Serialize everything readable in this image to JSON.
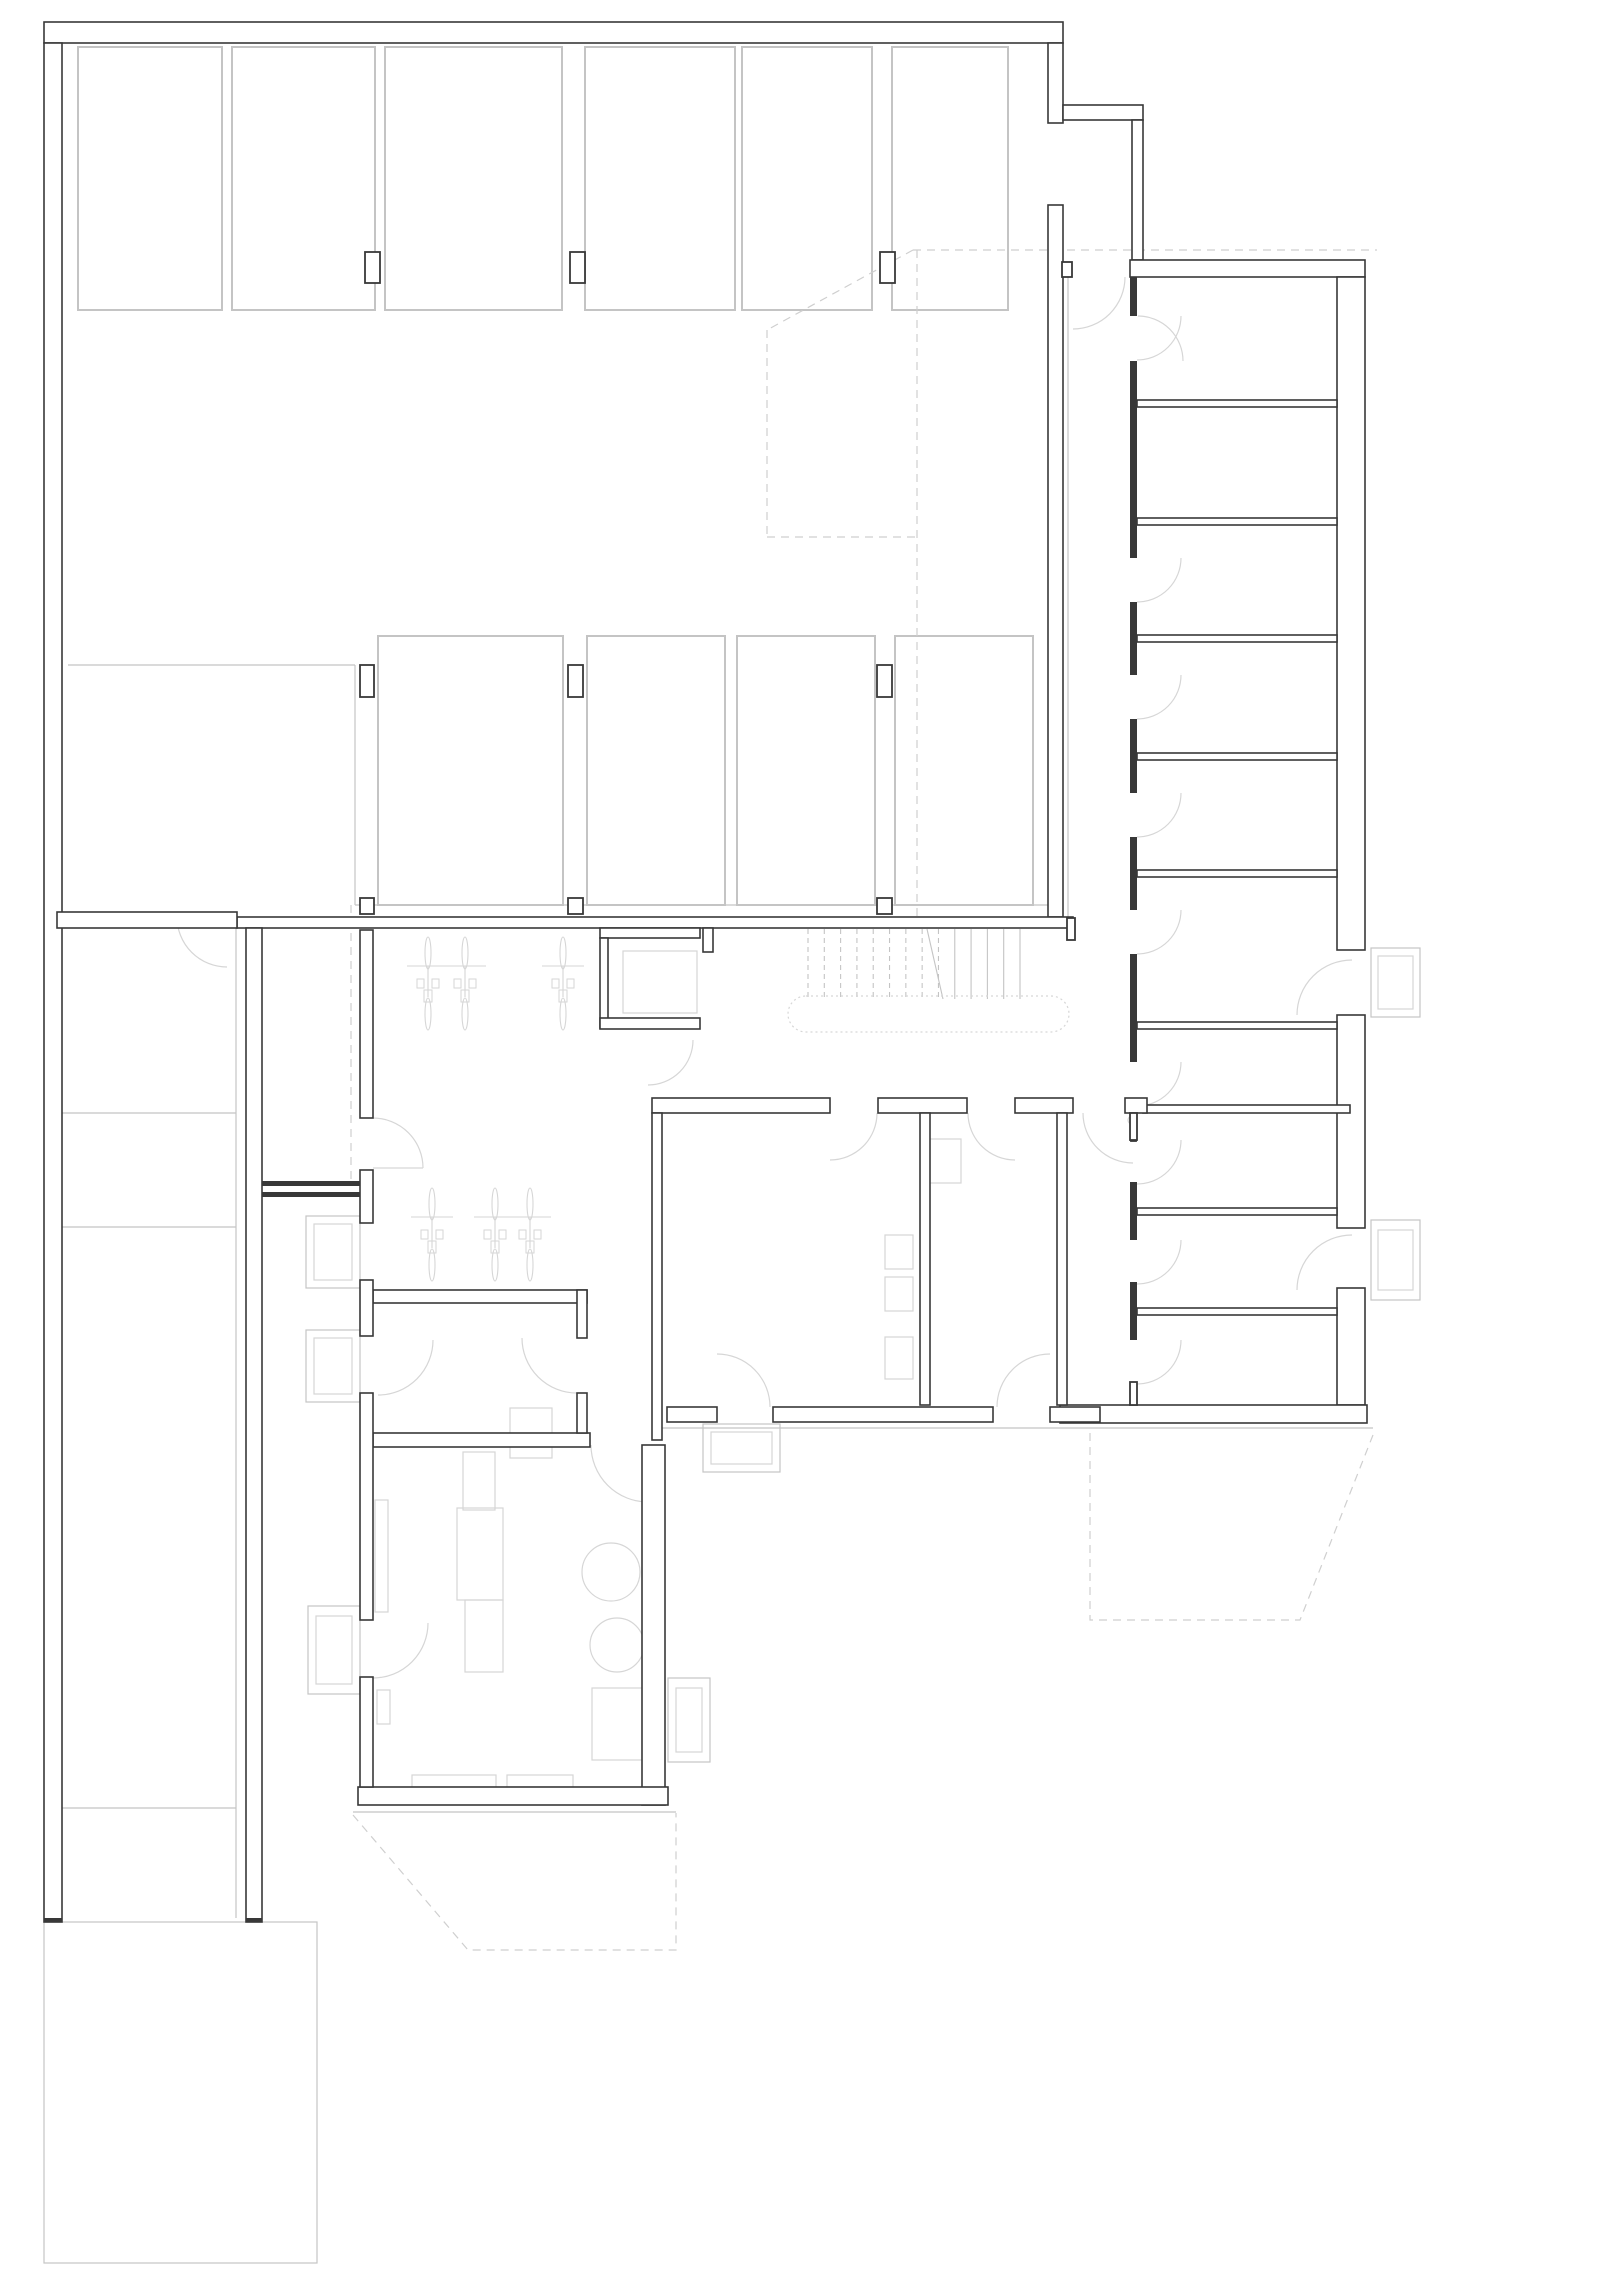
{
  "drawing_title": "basement-floor-plan",
  "colors": {
    "background": "#ffffff",
    "wall_dark": "#383838",
    "line_light": "#c4c4c4",
    "line_xlight": "#d6d6d6",
    "dash": "#cfcfcf"
  },
  "canvas": {
    "width": 1600,
    "height": 2285
  },
  "plan": {
    "dwalls": [
      {
        "x": 44,
        "y": 22,
        "w": 1019,
        "h": 21
      },
      {
        "x": 44,
        "y": 43,
        "w": 18,
        "h": 1879
      },
      {
        "x": 1048,
        "y": 43,
        "w": 15,
        "h": 80
      },
      {
        "x": 1048,
        "y": 205,
        "w": 15,
        "h": 712
      },
      {
        "x": 1063,
        "y": 105,
        "w": 80,
        "h": 15
      },
      {
        "x": 1132,
        "y": 120,
        "w": 11,
        "h": 140
      },
      {
        "x": 237,
        "y": 917,
        "w": 836,
        "h": 11
      },
      {
        "x": 57,
        "y": 912,
        "w": 180,
        "h": 16
      },
      {
        "x": 246,
        "y": 928,
        "w": 16,
        "h": 994
      },
      {
        "x": 1130,
        "y": 260,
        "w": 235,
        "h": 17
      },
      {
        "x": 1337,
        "y": 277,
        "w": 28,
        "h": 673
      },
      {
        "x": 1337,
        "y": 1015,
        "w": 28,
        "h": 213
      },
      {
        "x": 1337,
        "y": 1288,
        "w": 28,
        "h": 117
      },
      {
        "x": 1137,
        "y": 400,
        "w": 200,
        "h": 7
      },
      {
        "x": 1137,
        "y": 518,
        "w": 200,
        "h": 7
      },
      {
        "x": 1137,
        "y": 635,
        "w": 200,
        "h": 7
      },
      {
        "x": 1137,
        "y": 753,
        "w": 200,
        "h": 7
      },
      {
        "x": 1137,
        "y": 870,
        "w": 200,
        "h": 7
      },
      {
        "x": 1137,
        "y": 1022,
        "w": 200,
        "h": 7
      },
      {
        "x": 1137,
        "y": 1208,
        "w": 200,
        "h": 7
      },
      {
        "x": 1137,
        "y": 1308,
        "w": 200,
        "h": 7
      },
      {
        "x": 1143,
        "y": 1105,
        "w": 207,
        "h": 8
      },
      {
        "x": 1060,
        "y": 1405,
        "w": 307,
        "h": 18
      },
      {
        "x": 652,
        "y": 1098,
        "w": 178,
        "h": 15
      },
      {
        "x": 878,
        "y": 1098,
        "w": 89,
        "h": 15
      },
      {
        "x": 1015,
        "y": 1098,
        "w": 58,
        "h": 15
      },
      {
        "x": 1125,
        "y": 1098,
        "w": 22,
        "h": 15
      },
      {
        "x": 600,
        "y": 928,
        "w": 100,
        "h": 10
      },
      {
        "x": 600,
        "y": 938,
        "w": 8,
        "h": 90
      },
      {
        "x": 600,
        "y": 1018,
        "w": 100,
        "h": 11
      },
      {
        "x": 703,
        "y": 928,
        "w": 10,
        "h": 24
      },
      {
        "x": 652,
        "y": 1113,
        "w": 10,
        "h": 327
      },
      {
        "x": 920,
        "y": 1113,
        "w": 10,
        "h": 292
      },
      {
        "x": 1057,
        "y": 1113,
        "w": 10,
        "h": 292
      },
      {
        "x": 667,
        "y": 1407,
        "w": 50,
        "h": 15
      },
      {
        "x": 773,
        "y": 1407,
        "w": 220,
        "h": 15
      },
      {
        "x": 1050,
        "y": 1407,
        "w": 50,
        "h": 15
      },
      {
        "x": 373,
        "y": 1290,
        "w": 214,
        "h": 13
      },
      {
        "x": 577,
        "y": 1290,
        "w": 10,
        "h": 48
      },
      {
        "x": 373,
        "y": 1433,
        "w": 217,
        "h": 14
      },
      {
        "x": 577,
        "y": 1393,
        "w": 10,
        "h": 40
      },
      {
        "x": 642,
        "y": 1445,
        "w": 23,
        "h": 360
      },
      {
        "x": 358,
        "y": 1787,
        "w": 310,
        "h": 18
      },
      {
        "x": 360,
        "y": 1393,
        "w": 13,
        "h": 227
      },
      {
        "x": 360,
        "y": 1677,
        "w": 13,
        "h": 110
      },
      {
        "x": 360,
        "y": 930,
        "w": 13,
        "h": 188
      },
      {
        "x": 360,
        "y": 1170,
        "w": 13,
        "h": 53
      },
      {
        "x": 360,
        "y": 1280,
        "w": 13,
        "h": 56
      }
    ],
    "swalls": [
      {
        "x": 365,
        "y": 252,
        "w": 15,
        "h": 31
      },
      {
        "x": 570,
        "y": 252,
        "w": 15,
        "h": 31
      },
      {
        "x": 880,
        "y": 252,
        "w": 15,
        "h": 31
      },
      {
        "x": 360,
        "y": 665,
        "w": 14,
        "h": 32
      },
      {
        "x": 568,
        "y": 665,
        "w": 15,
        "h": 32
      },
      {
        "x": 877,
        "y": 665,
        "w": 15,
        "h": 32
      },
      {
        "x": 360,
        "y": 898,
        "w": 14,
        "h": 16
      },
      {
        "x": 568,
        "y": 898,
        "w": 15,
        "h": 16
      },
      {
        "x": 877,
        "y": 898,
        "w": 15,
        "h": 16
      },
      {
        "x": 1062,
        "y": 262,
        "w": 10,
        "h": 15
      },
      {
        "x": 1067,
        "y": 918,
        "w": 8,
        "h": 22
      },
      {
        "x": 262,
        "y": 1181,
        "w": 98,
        "h": 5
      },
      {
        "x": 262,
        "y": 1192,
        "w": 98,
        "h": 5
      },
      {
        "x": 44,
        "y": 1918,
        "w": 18,
        "h": 4
      },
      {
        "x": 246,
        "y": 1918,
        "w": 16,
        "h": 4
      },
      {
        "x": 1131,
        "y": 1125,
        "w": 5,
        "h": 16
      },
      {
        "x": 1130,
        "y": 277,
        "w": 7,
        "h": 39
      },
      {
        "x": 1130,
        "y": 361,
        "w": 7,
        "h": 197
      },
      {
        "x": 1130,
        "y": 602,
        "w": 7,
        "h": 73
      },
      {
        "x": 1130,
        "y": 719,
        "w": 7,
        "h": 74
      },
      {
        "x": 1130,
        "y": 837,
        "w": 7,
        "h": 73
      },
      {
        "x": 1130,
        "y": 954,
        "w": 7,
        "h": 108
      },
      {
        "x": 1130,
        "y": 1113,
        "w": 7,
        "h": 27
      },
      {
        "x": 1130,
        "y": 1182,
        "w": 7,
        "h": 58
      },
      {
        "x": 1130,
        "y": 1282,
        "w": 7,
        "h": 58
      },
      {
        "x": 1130,
        "y": 1382,
        "w": 7,
        "h": 23
      }
    ],
    "stalls": [
      {
        "x": 78,
        "y": 47,
        "w": 144,
        "h": 263
      },
      {
        "x": 232,
        "y": 47,
        "w": 143,
        "h": 263
      },
      {
        "x": 385,
        "y": 47,
        "w": 177,
        "h": 263
      },
      {
        "x": 585,
        "y": 47,
        "w": 150,
        "h": 263
      },
      {
        "x": 742,
        "y": 47,
        "w": 130,
        "h": 263
      },
      {
        "x": 892,
        "y": 47,
        "w": 116,
        "h": 263
      },
      {
        "x": 378,
        "y": 636,
        "w": 185,
        "h": 269
      },
      {
        "x": 587,
        "y": 636,
        "w": 138,
        "h": 269
      },
      {
        "x": 737,
        "y": 636,
        "w": 138,
        "h": 269
      },
      {
        "x": 895,
        "y": 636,
        "w": 138,
        "h": 269
      }
    ],
    "lrects": [
      {
        "x": 44,
        "y": 1922,
        "w": 273,
        "h": 341,
        "cls": "light"
      },
      {
        "x": 306,
        "y": 1216,
        "w": 54,
        "h": 72,
        "cls": "light"
      },
      {
        "x": 314,
        "y": 1224,
        "w": 38,
        "h": 56,
        "cls": "xlight"
      },
      {
        "x": 306,
        "y": 1330,
        "w": 54,
        "h": 72,
        "cls": "light"
      },
      {
        "x": 314,
        "y": 1338,
        "w": 38,
        "h": 56,
        "cls": "xlight"
      },
      {
        "x": 308,
        "y": 1606,
        "w": 52,
        "h": 88,
        "cls": "light"
      },
      {
        "x": 316,
        "y": 1616,
        "w": 36,
        "h": 68,
        "cls": "xlight"
      },
      {
        "x": 703,
        "y": 1424,
        "w": 77,
        "h": 48,
        "cls": "light"
      },
      {
        "x": 711,
        "y": 1432,
        "w": 61,
        "h": 32,
        "cls": "xlight"
      },
      {
        "x": 668,
        "y": 1678,
        "w": 42,
        "h": 84,
        "cls": "light"
      },
      {
        "x": 676,
        "y": 1688,
        "w": 26,
        "h": 64,
        "cls": "xlight"
      },
      {
        "x": 1371,
        "y": 948,
        "w": 49,
        "h": 69,
        "cls": "light"
      },
      {
        "x": 1378,
        "y": 956,
        "w": 35,
        "h": 53,
        "cls": "xlight"
      },
      {
        "x": 1371,
        "y": 1220,
        "w": 49,
        "h": 80,
        "cls": "light"
      },
      {
        "x": 1378,
        "y": 1230,
        "w": 35,
        "h": 60,
        "cls": "xlight"
      },
      {
        "x": 623,
        "y": 951,
        "w": 74,
        "h": 62,
        "cls": "xlight"
      },
      {
        "x": 457,
        "y": 1508,
        "w": 46,
        "h": 92,
        "cls": "xlight"
      },
      {
        "x": 465,
        "y": 1600,
        "w": 38,
        "h": 72,
        "cls": "xlight"
      },
      {
        "x": 463,
        "y": 1452,
        "w": 32,
        "h": 58,
        "cls": "xlight"
      },
      {
        "x": 510,
        "y": 1408,
        "w": 42,
        "h": 50,
        "cls": "xlight"
      },
      {
        "x": 412,
        "y": 1775,
        "w": 84,
        "h": 12,
        "cls": "xlight"
      },
      {
        "x": 507,
        "y": 1775,
        "w": 66,
        "h": 12,
        "cls": "xlight"
      },
      {
        "x": 375,
        "y": 1500,
        "w": 13,
        "h": 112,
        "cls": "xlight"
      },
      {
        "x": 377,
        "y": 1690,
        "w": 13,
        "h": 34,
        "cls": "xlight"
      },
      {
        "x": 592,
        "y": 1688,
        "w": 50,
        "h": 72,
        "cls": "xlight"
      },
      {
        "x": 885,
        "y": 1235,
        "w": 28,
        "h": 34,
        "cls": "xlight"
      },
      {
        "x": 885,
        "y": 1277,
        "w": 28,
        "h": 34,
        "cls": "xlight"
      },
      {
        "x": 885,
        "y": 1337,
        "w": 28,
        "h": 42,
        "cls": "xlight"
      },
      {
        "x": 929,
        "y": 1139,
        "w": 32,
        "h": 44,
        "cls": "xlight"
      }
    ],
    "llines": [
      {
        "x1": 59,
        "y1": 928,
        "x2": 59,
        "y2": 1918,
        "cls": "light"
      },
      {
        "x1": 236,
        "y1": 928,
        "x2": 236,
        "y2": 1918,
        "cls": "light"
      },
      {
        "x1": 59,
        "y1": 1113,
        "x2": 236,
        "y2": 1113,
        "cls": "light"
      },
      {
        "x1": 59,
        "y1": 1227,
        "x2": 236,
        "y2": 1227,
        "cls": "light"
      },
      {
        "x1": 59,
        "y1": 1808,
        "x2": 236,
        "y2": 1808,
        "cls": "light"
      },
      {
        "x1": 68,
        "y1": 665,
        "x2": 355,
        "y2": 665,
        "cls": "light"
      },
      {
        "x1": 355,
        "y1": 665,
        "x2": 355,
        "y2": 905,
        "cls": "light"
      },
      {
        "x1": 355,
        "y1": 905,
        "x2": 1048,
        "y2": 905,
        "cls": "light"
      },
      {
        "x1": 1068,
        "y1": 277,
        "x2": 1068,
        "y2": 918,
        "cls": "light"
      },
      {
        "x1": 660,
        "y1": 1428,
        "x2": 1373,
        "y2": 1428,
        "cls": "light"
      },
      {
        "x1": 353,
        "y1": 1812,
        "x2": 676,
        "y2": 1812,
        "cls": "light"
      },
      {
        "x1": 373,
        "y1": 1168,
        "x2": 423,
        "y2": 1168,
        "cls": "xlight"
      }
    ],
    "dashes": [
      {
        "pts": [
          [
            913,
            250
          ],
          [
            1377,
            250
          ]
        ]
      },
      {
        "pts": [
          [
            913,
            250
          ],
          [
            767,
            330
          ]
        ]
      },
      {
        "pts": [
          [
            767,
            330
          ],
          [
            767,
            537
          ]
        ]
      },
      {
        "pts": [
          [
            767,
            537
          ],
          [
            917,
            537
          ]
        ]
      },
      {
        "pts": [
          [
            917,
            250
          ],
          [
            917,
            918
          ]
        ]
      },
      {
        "pts": [
          [
            351,
            905
          ],
          [
            351,
            1180
          ]
        ]
      },
      {
        "pts": [
          [
            353,
            1815
          ],
          [
            468,
            1950
          ],
          [
            676,
            1950
          ],
          [
            676,
            1813
          ]
        ]
      },
      {
        "pts": [
          [
            1090,
            1433
          ],
          [
            1090,
            1620
          ],
          [
            1300,
            1620
          ],
          [
            1373,
            1435
          ]
        ]
      }
    ],
    "arcs": [
      {
        "cx": 1137,
        "cy": 316,
        "r": 44,
        "a0": 0,
        "a1": 90
      },
      {
        "cx": 1137,
        "cy": 558,
        "r": 44,
        "a0": 0,
        "a1": 90
      },
      {
        "cx": 1137,
        "cy": 675,
        "r": 44,
        "a0": 0,
        "a1": 90
      },
      {
        "cx": 1137,
        "cy": 793,
        "r": 44,
        "a0": 0,
        "a1": 90
      },
      {
        "cx": 1137,
        "cy": 910,
        "r": 44,
        "a0": 0,
        "a1": 90
      },
      {
        "cx": 1137,
        "cy": 1062,
        "r": 44,
        "a0": 0,
        "a1": 90
      },
      {
        "cx": 1137,
        "cy": 1140,
        "r": 44,
        "a0": 0,
        "a1": 90
      },
      {
        "cx": 1137,
        "cy": 1240,
        "r": 44,
        "a0": 0,
        "a1": 90
      },
      {
        "cx": 1137,
        "cy": 1340,
        "r": 44,
        "a0": 0,
        "a1": 90
      },
      {
        "cx": 227,
        "cy": 917,
        "r": 50,
        "a0": 90,
        "a1": 180
      },
      {
        "cx": 1073,
        "cy": 277,
        "r": 52,
        "a0": 0,
        "a1": 90
      },
      {
        "cx": 1138,
        "cy": 361,
        "r": 45,
        "a0": 270,
        "a1": 360
      },
      {
        "cx": 373,
        "cy": 1168,
        "r": 50,
        "a0": 270,
        "a1": 360
      },
      {
        "cx": 648,
        "cy": 1040,
        "r": 45,
        "a0": 0,
        "a1": 90
      },
      {
        "cx": 830,
        "cy": 1113,
        "r": 47,
        "a0": 0,
        "a1": 90
      },
      {
        "cx": 1015,
        "cy": 1113,
        "r": 47,
        "a0": 90,
        "a1": 180
      },
      {
        "cx": 717,
        "cy": 1407,
        "r": 53,
        "a0": 270,
        "a1": 360
      },
      {
        "cx": 1050,
        "cy": 1407,
        "r": 53,
        "a0": 180,
        "a1": 270
      },
      {
        "cx": 577,
        "cy": 1338,
        "r": 55,
        "a0": 90,
        "a1": 180
      },
      {
        "cx": 378,
        "cy": 1340,
        "r": 55,
        "a0": 0,
        "a1": 90
      },
      {
        "cx": 648,
        "cy": 1445,
        "r": 57,
        "a0": 90,
        "a1": 180
      },
      {
        "cx": 373,
        "cy": 1623,
        "r": 55,
        "a0": 0,
        "a1": 90
      },
      {
        "cx": 1352,
        "cy": 1015,
        "r": 55,
        "a0": 180,
        "a1": 270
      },
      {
        "cx": 1352,
        "cy": 1290,
        "r": 55,
        "a0": 180,
        "a1": 270
      },
      {
        "cx": 1133,
        "cy": 1113,
        "r": 50,
        "a0": 90,
        "a1": 180
      }
    ],
    "circles": [
      {
        "cx": 611,
        "cy": 1572,
        "r": 29
      },
      {
        "cx": 617,
        "cy": 1645,
        "r": 27
      },
      {
        "cx": 1132,
        "cy": 1120,
        "r": 4
      }
    ],
    "stadium": {
      "x": 788,
      "y": 996,
      "w": 281,
      "h": 36
    },
    "stairs": {
      "x0": 808,
      "x1": 1020,
      "y0": 929,
      "y1": 999,
      "n": 14,
      "dashedUntil": 943,
      "cut": [
        927,
        929,
        943,
        999
      ]
    },
    "bikes": [
      {
        "x": 428,
        "y": 935
      },
      {
        "x": 465,
        "y": 935
      },
      {
        "x": 563,
        "y": 935
      },
      {
        "x": 432,
        "y": 1186
      },
      {
        "x": 495,
        "y": 1186
      },
      {
        "x": 530,
        "y": 1186
      }
    ]
  }
}
